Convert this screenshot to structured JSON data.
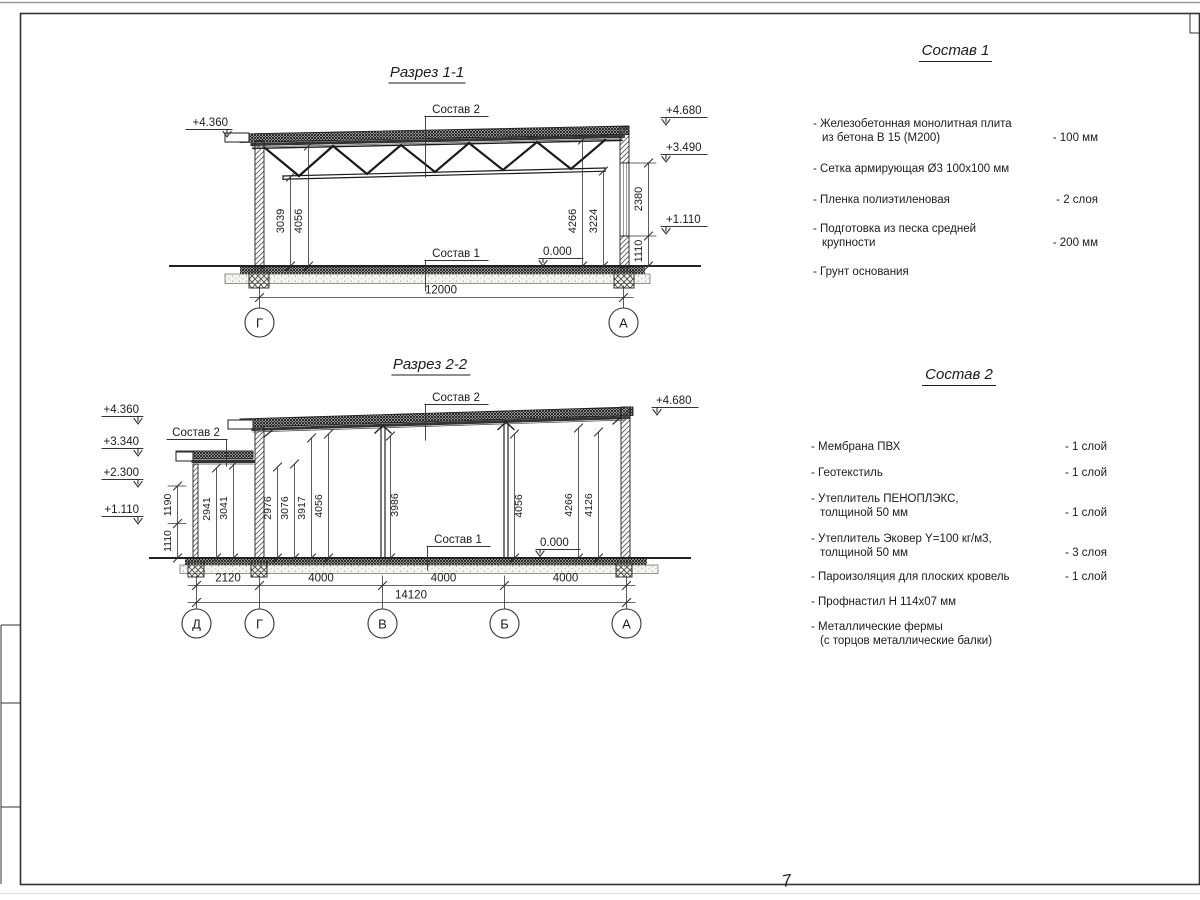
{
  "page": {
    "sheet_mark": "7"
  },
  "s1": {
    "title": "Разрез 1-1",
    "labels": {
      "sostav2": "Состав 2",
      "sostav1": "Состав 1",
      "zero": "0.000"
    },
    "elev": {
      "l1": "+4.360",
      "r1": "+4.680",
      "r2": "+3.490",
      "r3": "+1.110"
    },
    "dims": {
      "d3039": "3039",
      "d4056": "4056",
      "d4266": "4266",
      "d3224": "3224",
      "d2380": "2380",
      "d1110": "1110",
      "w": "12000"
    },
    "axes": {
      "a1": "Г",
      "a2": "А"
    }
  },
  "s2": {
    "title": "Разрез 2-2",
    "labels": {
      "sostav2_annex": "Состав 2",
      "sostav2_main": "Состав 2",
      "sostav1": "Состав 1",
      "zero": "0.000"
    },
    "elev": {
      "l1": "+4.360",
      "l2": "+3.340",
      "l3": "+2.300",
      "l4": "+1.110",
      "r1": "+4.680"
    },
    "vdims": {
      "v1190": "1190",
      "v1110": "1110"
    },
    "dims": [
      "2941",
      "3041",
      "2976",
      "3076",
      "3917",
      "4056",
      "3986",
      "4056",
      "4266",
      "4126"
    ],
    "bottom": [
      "2120",
      "4000",
      "4000",
      "4000"
    ],
    "total": "14120",
    "axes": [
      "Д",
      "Г",
      "В",
      "Б",
      "А"
    ]
  },
  "lists": {
    "sostav1": {
      "title": "Состав 1",
      "items": [
        {
          "l1": "- Железобетонная  монолитная плита",
          "l2": "из бетона В 15 (М200)",
          "v": "- 100 мм"
        },
        {
          "l1": "- Сетка армирующая Ø3 100x100 мм"
        },
        {
          "l1": "- Пленка полиэтиленовая",
          "v": "-  2 слоя"
        },
        {
          "l1": "- Подготовка из песка средней",
          "l2": "крупности",
          "v": "- 200 мм"
        },
        {
          "l1": "- Грунт основания"
        }
      ]
    },
    "sostav2": {
      "title": "Состав 2",
      "items": [
        {
          "l1": "- Мембрана ПВХ",
          "v": "- 1 слой"
        },
        {
          "l1": "- Геотекстиль",
          "v": "- 1 слой"
        },
        {
          "l1": "- Утеплитель ПЕНОПЛЭКС,",
          "l2": "толщиной 50 мм",
          "v": "- 1 слой"
        },
        {
          "l1": "- Утеплитель Эковер Y=100 кг/м3,",
          "l2": "толщиной 50 мм",
          "v": "- 3 слоя"
        },
        {
          "l1": "- Пароизоляция для плоских кровель",
          "v": "- 1 слой"
        },
        {
          "l1": "- Профнастил Н 114x07 мм"
        },
        {
          "l1": "- Металлические фермы",
          "l2": "(с торцов металлические балки)"
        }
      ]
    }
  }
}
